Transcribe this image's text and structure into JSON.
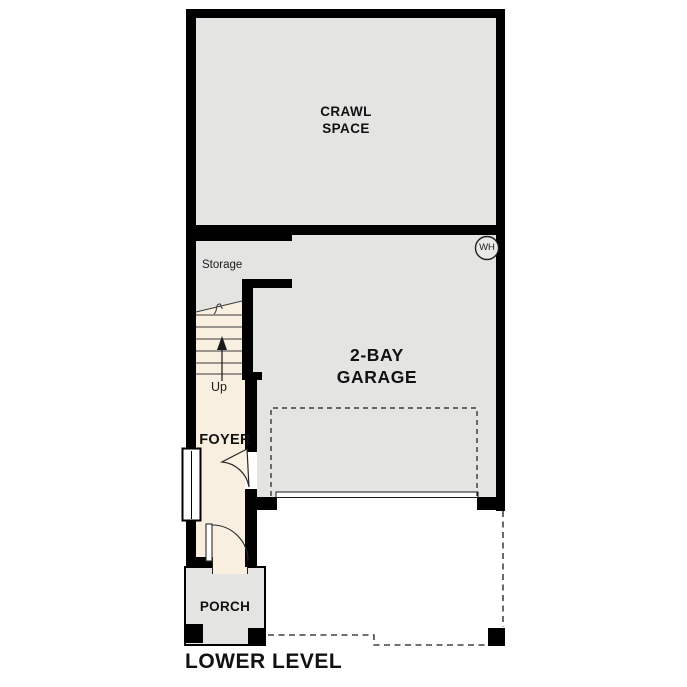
{
  "plan_title": "LOWER LEVEL",
  "rooms": {
    "crawl_space": "CRAWL\nSPACE",
    "storage": "Storage",
    "garage": "2-BAY\nGARAGE",
    "foyer": "FOYER",
    "porch": "PORCH"
  },
  "stairs": {
    "direction_label": "Up"
  },
  "fixtures": {
    "water_heater": "WH"
  },
  "colors": {
    "wall": "#000000",
    "room_fill_gray": "#e4e4e2",
    "room_fill_cream": "#f8efe0",
    "line": "#2b2b2b",
    "background": "#ffffff"
  }
}
